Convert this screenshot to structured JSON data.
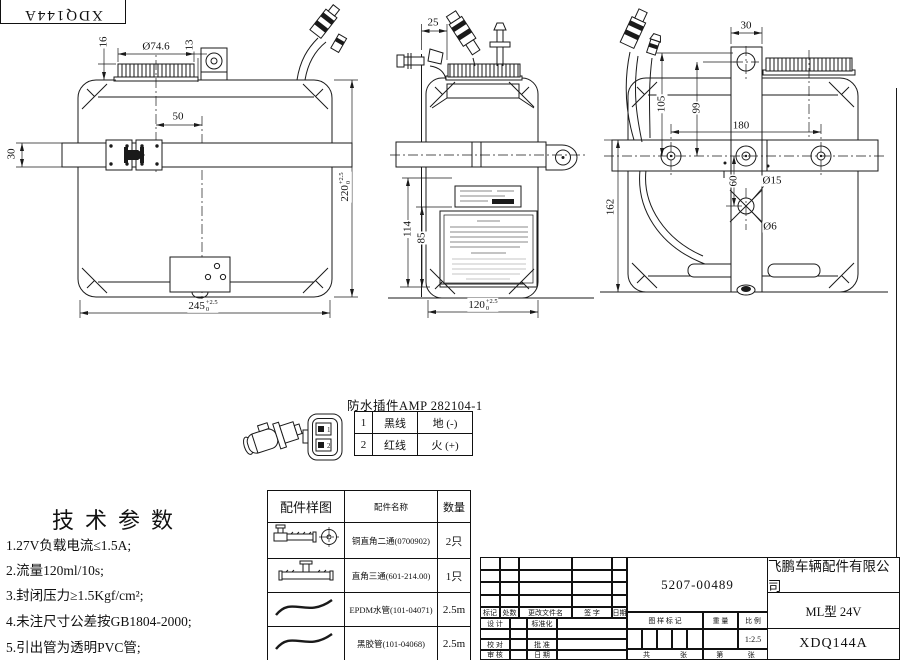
{
  "sheet": {
    "corner_code": "XDQ144A"
  },
  "dims": {
    "front_cap_dia": "Ø74.6",
    "front_cap_h": "16",
    "front_13": "13",
    "front_50": "50",
    "front_strap_h": "30",
    "front_width": {
      "value": "245",
      "tol_plus": "+2.5",
      "tol_minus": "0"
    },
    "front_height": {
      "value": "220",
      "tol_plus": "+2.5",
      "tol_minus": "0"
    },
    "side_25": "25",
    "side_114": "114",
    "side_85": "85",
    "side_depth": {
      "value": "120",
      "tol_plus": "+2.5",
      "tol_minus": "0"
    },
    "rear_30": "30",
    "rear_105": "105",
    "rear_99": "99",
    "rear_180": "180",
    "rear_60": "60",
    "rear_hole_big": "Ø15",
    "rear_hole_small": "Ø6",
    "rear_162": "162"
  },
  "connector": {
    "title": "防水插件AMP 282104-1",
    "pins": [
      {
        "no": "1",
        "wire": "黑线",
        "polarity": "地 (-)"
      },
      {
        "no": "2",
        "wire": "红线",
        "polarity": "火 (+)"
      }
    ]
  },
  "tech_params": {
    "title": "技术参数",
    "items": [
      "1.27V负载电流≤1.5A;",
      "2.流量120ml/10s;",
      "3.封闭压力≥1.5Kgf/cm²;",
      "4.未注尺寸公差按GB1804-2000;",
      "5.引出管为透明PVC管;"
    ]
  },
  "parts_table": {
    "headers": [
      "配件样图",
      "配件名称",
      "数量"
    ],
    "rows": [
      {
        "icon": "elbow-fitting",
        "name": "铜直角二通(0700902)",
        "qty": "2只"
      },
      {
        "icon": "tee-fitting",
        "name": "直角三通(601-214.00)",
        "qty": "1只"
      },
      {
        "icon": "hose",
        "name": "EPDM水管(101-04071)",
        "qty": "2.5m"
      },
      {
        "icon": "hose",
        "name": "黑胶管(101-04068)",
        "qty": "2.5m"
      }
    ]
  },
  "title_block": {
    "drawing_no": "5207-00489",
    "company": "飞鹏车辆配件有限公司",
    "model": "ML型 24V",
    "part_code": "XDQ144A",
    "scale_value": "1:2.5",
    "labels": {
      "mark": "标记",
      "qty": "处数",
      "change_doc": "更改文件名",
      "signature": "签 字",
      "date": "日期",
      "design": "设 计",
      "standardization": "标准化",
      "check": "校 对",
      "approve": "批 准",
      "audit": "审 核",
      "date2": "日 期",
      "drawing_mark": "图 样 标 记",
      "weight": "重 量",
      "scale": "比 例",
      "total": "共",
      "sheets": "张",
      "no": "第",
      "sheet": "张"
    }
  }
}
